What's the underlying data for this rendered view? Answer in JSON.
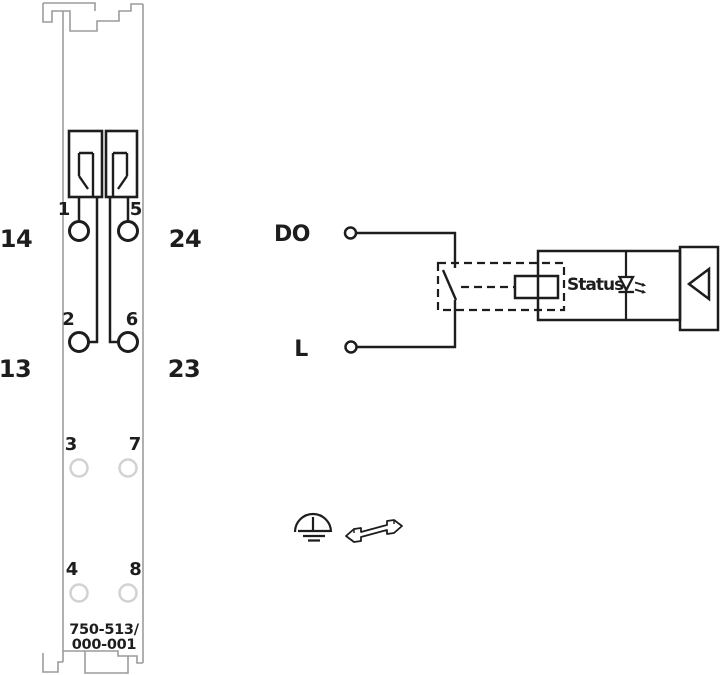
{
  "module": {
    "part_number": {
      "line1": "750-513/",
      "line2": "000-001"
    },
    "terminal_numbers": [
      "1",
      "5",
      "2",
      "6",
      "3",
      "7",
      "4",
      "8"
    ],
    "side_labels": [
      "14",
      "24",
      "13",
      "23"
    ]
  },
  "circuit": {
    "do_label": "DO",
    "l_label": "L",
    "status_label": "Status"
  },
  "icons": {
    "clamps": "cage-clamp-icon",
    "led": "status-led-icon",
    "bus": "bus-interface-triangle-icon",
    "ground": "earth-ground-icon",
    "rail": "din-rail-icon"
  },
  "colors": {
    "line_black": "#1d1d1d",
    "module_outline": "#9c9c9c",
    "unused_terminal": "#d2d2d2",
    "background": "#ffffff"
  }
}
